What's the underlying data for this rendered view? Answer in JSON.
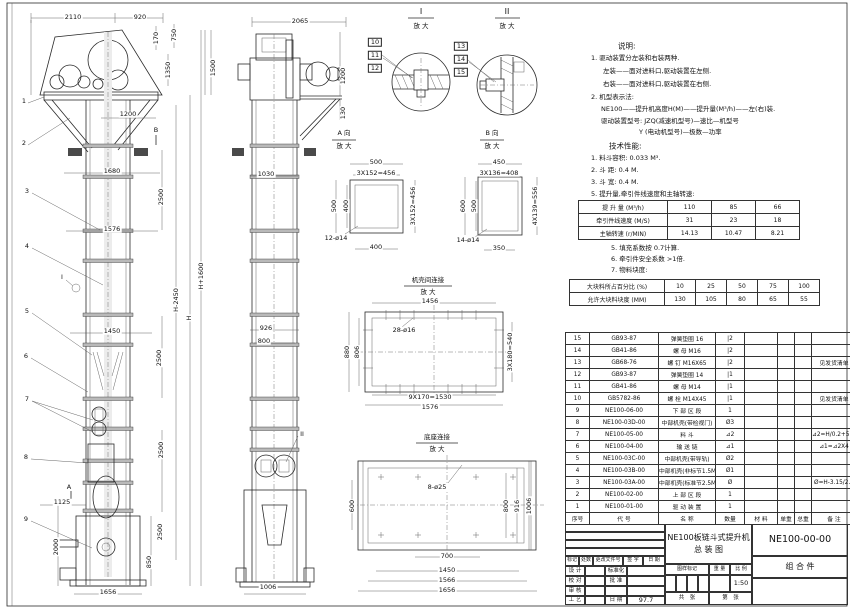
{
  "doc": {
    "drawing_title_line1": "NE100板链斗式提升机",
    "drawing_title_line2": "总  装  图",
    "drawing_no": "NE100-00-00",
    "part_class": "组 合 件",
    "scale": "1:50",
    "date": "97.7"
  },
  "notes_lines": [
    {
      "t": "说明:",
      "x": 617,
      "y": 46,
      "fs": 7.5
    },
    {
      "t": "1. 驱动装置分左装和右装两种.",
      "x": 590,
      "y": 58
    },
    {
      "t": "左装——面对进料口,驱动装置在左侧.",
      "x": 602,
      "y": 71
    },
    {
      "t": "右装——面对进料口,驱动装置在右侧.",
      "x": 602,
      "y": 84
    },
    {
      "t": "2. 机型表示法:",
      "x": 590,
      "y": 97
    },
    {
      "t": "NE100——提升机高度H(M)——提升量(M³/h)——左(右)装.",
      "x": 600,
      "y": 109
    },
    {
      "t": "驱动装置型号: JZQ(减速机型号)—速比—机型号",
      "x": 600,
      "y": 121
    },
    {
      "t": "Y (电动机型号)—极数—功率",
      "x": 638,
      "y": 132
    },
    {
      "t": "技术性能:",
      "x": 608,
      "y": 146,
      "fs": 7.5
    },
    {
      "t": "1. 料斗容积: 0.033 M³.",
      "x": 590,
      "y": 158
    },
    {
      "t": "2. 斗  距: 0.4 M.",
      "x": 590,
      "y": 170
    },
    {
      "t": "3. 斗  宽: 0.4 M.",
      "x": 590,
      "y": 182
    },
    {
      "t": "5. 提升量,牵引件线速度和主轴转速:",
      "x": 590,
      "y": 194
    },
    {
      "t": "5. 填充系数按 0.7计算.",
      "x": 610,
      "y": 248
    },
    {
      "t": "6. 牵引件安全系数 >1倍.",
      "x": 610,
      "y": 259
    },
    {
      "t": "7. 物料块度:",
      "x": 610,
      "y": 270
    }
  ],
  "tech_table1": {
    "rows": [
      {
        "label": "提 升 量 (M³/h)",
        "values": [
          "110",
          "85",
          "66"
        ]
      },
      {
        "label": "牵引件线速度 (M/S)",
        "values": [
          "31",
          "23",
          "18"
        ]
      },
      {
        "label": "主轴转速 (r/MIN)",
        "values": [
          "14.13",
          "10.47",
          "8.21"
        ]
      }
    ]
  },
  "tech_table2": {
    "rows": [
      {
        "label": "大块料所占百分比 (%)",
        "values": [
          "10",
          "25",
          "50",
          "75",
          "100"
        ]
      },
      {
        "label": "允许大块料块度 (MM)",
        "values": [
          "130",
          "105",
          "80",
          "65",
          "55"
        ]
      }
    ]
  },
  "bom": {
    "headers": [
      "序号",
      "代  号",
      "名  称",
      "数量",
      "材  料",
      "单重",
      "总重",
      "备 注"
    ],
    "rows": [
      [
        "15",
        "GB93-87",
        "弹簧垫圈 16",
        "|2",
        "",
        "",
        "",
        ""
      ],
      [
        "14",
        "GB41-86",
        "螺 母 M16",
        "|2",
        "",
        "",
        "",
        ""
      ],
      [
        "13",
        "GB68-76",
        "螺 钉 M16X65",
        "|2",
        "",
        "",
        "",
        "见发货清单"
      ],
      [
        "12",
        "GB93-87",
        "弹簧垫圈 14",
        "|1",
        "",
        "",
        "",
        ""
      ],
      [
        "11",
        "GB41-86",
        "螺 母 M14",
        "|1",
        "",
        "",
        "",
        ""
      ],
      [
        "10",
        "GB5782-86",
        "螺 栓 M14X45",
        "|1",
        "",
        "",
        "",
        "见发货清单"
      ],
      [
        "9",
        "NE100-06-00",
        "下 部 区 段",
        "1",
        "",
        "",
        "",
        ""
      ],
      [
        "8",
        "NE100-03D-00",
        "中部机壳(带检视门)",
        "Ø3",
        "",
        "",
        "",
        ""
      ],
      [
        "7",
        "NE100-05-00",
        "料  斗",
        "⊿2",
        "",
        "",
        "",
        "⊿2=H/0.2+5.75"
      ],
      [
        "6",
        "NE100-04-00",
        "输 送 链",
        "⊿1",
        "",
        "",
        "",
        "⊿1=⊿2X4"
      ],
      [
        "5",
        "NE100-03C-00",
        "中部机壳(带导轨)",
        "Ø2",
        "",
        "",
        "",
        ""
      ],
      [
        "4",
        "NE100-03B-00",
        "中部机壳(非标节1.5M,1M)",
        "Ø1",
        "",
        "",
        "",
        ""
      ],
      [
        "3",
        "NE100-03A-00",
        "中部机壳(标准节2.5M)",
        "Ø",
        "",
        "",
        "",
        "Ø=H-3.15/2.5"
      ],
      [
        "2",
        "NE100-02-00",
        "上 部 区 段",
        "1",
        "",
        "",
        "",
        ""
      ],
      [
        "1",
        "NE100-01-00",
        "驱 动 装 置",
        "1",
        "",
        "",
        "",
        ""
      ]
    ]
  },
  "title_block_cells": [
    {
      "x": 565,
      "y": 524,
      "w": 100,
      "h": 8,
      "t": ""
    },
    {
      "x": 565,
      "y": 532,
      "w": 100,
      "h": 8,
      "t": ""
    },
    {
      "x": 565,
      "y": 540,
      "w": 100,
      "h": 8,
      "t": ""
    },
    {
      "x": 565,
      "y": 548,
      "w": 100,
      "h": 8,
      "t": ""
    },
    {
      "x": 565,
      "y": 556,
      "w": 14,
      "h": 10,
      "t": "标记",
      "fs": 5
    },
    {
      "x": 579,
      "y": 556,
      "w": 14,
      "h": 10,
      "t": "处数",
      "fs": 5
    },
    {
      "x": 593,
      "y": 556,
      "w": 30,
      "h": 10,
      "t": "更改文件号",
      "fs": 5
    },
    {
      "x": 623,
      "y": 556,
      "w": 20,
      "h": 10,
      "t": "签 字",
      "fs": 5
    },
    {
      "x": 643,
      "y": 556,
      "w": 22,
      "h": 10,
      "t": "日 期",
      "fs": 5
    },
    {
      "x": 565,
      "y": 566,
      "w": 20,
      "h": 10,
      "t": "设 计",
      "fs": 5.5
    },
    {
      "x": 585,
      "y": 566,
      "w": 20,
      "h": 10,
      "t": ""
    },
    {
      "x": 605,
      "y": 566,
      "w": 22,
      "h": 10,
      "t": "标准化",
      "fs": 5.5
    },
    {
      "x": 627,
      "y": 566,
      "w": 38,
      "h": 10,
      "t": ""
    },
    {
      "x": 565,
      "y": 576,
      "w": 20,
      "h": 10,
      "t": "校 对",
      "fs": 5.5
    },
    {
      "x": 585,
      "y": 576,
      "w": 20,
      "h": 10,
      "t": ""
    },
    {
      "x": 605,
      "y": 576,
      "w": 22,
      "h": 10,
      "t": "批 准",
      "fs": 5.5
    },
    {
      "x": 627,
      "y": 576,
      "w": 38,
      "h": 10,
      "t": ""
    },
    {
      "x": 565,
      "y": 586,
      "w": 20,
      "h": 10,
      "t": "审 核",
      "fs": 5.5
    },
    {
      "x": 585,
      "y": 586,
      "w": 20,
      "h": 10,
      "t": ""
    },
    {
      "x": 605,
      "y": 586,
      "w": 22,
      "h": 10,
      "t": ""
    },
    {
      "x": 627,
      "y": 586,
      "w": 38,
      "h": 10,
      "t": ""
    },
    {
      "x": 565,
      "y": 596,
      "w": 20,
      "h": 9,
      "t": "工 艺",
      "fs": 5.5
    },
    {
      "x": 585,
      "y": 596,
      "w": 20,
      "h": 9,
      "t": ""
    },
    {
      "x": 605,
      "y": 596,
      "w": 22,
      "h": 9,
      "t": "日 期",
      "fs": 5.5
    },
    {
      "x": 627,
      "y": 596,
      "w": 38,
      "h": 9,
      "t": "97.7",
      "fs": 6.5
    },
    {
      "x": 665,
      "y": 524,
      "w": 87,
      "h": 40,
      "t": "NE100板链斗式提升机\n总  装  图",
      "fs": 8
    },
    {
      "x": 665,
      "y": 564,
      "w": 44,
      "h": 11,
      "t": "图样标记",
      "fs": 5
    },
    {
      "x": 709,
      "y": 564,
      "w": 21,
      "h": 11,
      "t": "重 量",
      "fs": 5
    },
    {
      "x": 730,
      "y": 564,
      "w": 22,
      "h": 11,
      "t": "比 例",
      "fs": 5
    },
    {
      "x": 665,
      "y": 575,
      "w": 11,
      "h": 17,
      "t": ""
    },
    {
      "x": 676,
      "y": 575,
      "w": 11,
      "h": 17,
      "t": ""
    },
    {
      "x": 687,
      "y": 575,
      "w": 11,
      "h": 17,
      "t": ""
    },
    {
      "x": 698,
      "y": 575,
      "w": 11,
      "h": 17,
      "t": ""
    },
    {
      "x": 709,
      "y": 575,
      "w": 21,
      "h": 17,
      "t": ""
    },
    {
      "x": 730,
      "y": 575,
      "w": 22,
      "h": 17,
      "t": "1:50",
      "fs": 6.5
    },
    {
      "x": 665,
      "y": 592,
      "w": 44,
      "h": 13,
      "t": "共　张",
      "fs": 5.5
    },
    {
      "x": 709,
      "y": 592,
      "w": 43,
      "h": 13,
      "t": "第　张",
      "fs": 5.5
    },
    {
      "x": 752,
      "y": 524,
      "w": 96,
      "h": 32,
      "t": "NE100-00-00",
      "fs": 9.5
    },
    {
      "x": 752,
      "y": 556,
      "w": 96,
      "h": 22,
      "t": "组 合 件",
      "fs": 8
    },
    {
      "x": 752,
      "y": 578,
      "w": 96,
      "h": 27,
      "t": ""
    }
  ],
  "labels": {
    "main_view": [
      {
        "t": "2110",
        "x": 73,
        "y": 17
      },
      {
        "t": "920",
        "x": 140,
        "y": 17
      },
      {
        "t": "170",
        "x": 156,
        "y": 38,
        "r": 1
      },
      {
        "t": "750",
        "x": 174,
        "y": 35,
        "r": 1
      },
      {
        "t": "1350",
        "x": 168,
        "y": 70,
        "r": 1
      },
      {
        "t": "1500",
        "x": 213,
        "y": 68,
        "r": 1
      },
      {
        "t": "1200",
        "x": 128,
        "y": 114
      },
      {
        "t": "1680",
        "x": 112,
        "y": 171
      },
      {
        "t": "2500",
        "x": 161,
        "y": 197,
        "r": 1
      },
      {
        "t": "1576",
        "x": 112,
        "y": 229
      },
      {
        "t": "H-2450",
        "x": 176,
        "y": 300,
        "r": 1
      },
      {
        "t": "H",
        "x": 189,
        "y": 318,
        "r": 1
      },
      {
        "t": "H+1600",
        "x": 201,
        "y": 276,
        "r": 1
      },
      {
        "t": "1450",
        "x": 112,
        "y": 331
      },
      {
        "t": "2500",
        "x": 159,
        "y": 358,
        "r": 1
      },
      {
        "t": "2500",
        "x": 161,
        "y": 450,
        "r": 1
      },
      {
        "t": "1125",
        "x": 62,
        "y": 502
      },
      {
        "t": "2000",
        "x": 56,
        "y": 547,
        "r": 1
      },
      {
        "t": "2500",
        "x": 160,
        "y": 532,
        "r": 1
      },
      {
        "t": "850",
        "x": 149,
        "y": 562,
        "r": 1
      },
      {
        "t": "1656",
        "x": 108,
        "y": 592
      },
      {
        "t": "B",
        "x": 156,
        "y": 130
      },
      {
        "t": "I",
        "x": 62,
        "y": 277
      },
      {
        "t": "A",
        "x": 69,
        "y": 487
      }
    ],
    "side_view": [
      {
        "t": "2065",
        "x": 300,
        "y": 21
      },
      {
        "t": "1200",
        "x": 343,
        "y": 76,
        "r": 1
      },
      {
        "t": "130",
        "x": 343,
        "y": 113,
        "r": 1
      },
      {
        "t": "1030",
        "x": 266,
        "y": 174
      },
      {
        "t": "926",
        "x": 266,
        "y": 328
      },
      {
        "t": "800",
        "x": 264,
        "y": 341
      },
      {
        "t": "1006",
        "x": 268,
        "y": 587
      },
      {
        "t": "II",
        "x": 302,
        "y": 434
      }
    ],
    "callouts": [
      {
        "t": "1",
        "x": 24,
        "y": 101
      },
      {
        "t": "2",
        "x": 24,
        "y": 143
      },
      {
        "t": "3",
        "x": 27,
        "y": 191
      },
      {
        "t": "4",
        "x": 27,
        "y": 246
      },
      {
        "t": "5",
        "x": 27,
        "y": 311
      },
      {
        "t": "6",
        "x": 26,
        "y": 356
      },
      {
        "t": "7",
        "x": 27,
        "y": 399
      },
      {
        "t": "8",
        "x": 26,
        "y": 457
      },
      {
        "t": "9",
        "x": 26,
        "y": 519
      },
      {
        "t": "10",
        "x": 375,
        "y": 42,
        "b": 1
      },
      {
        "t": "11",
        "x": 375,
        "y": 55,
        "b": 1
      },
      {
        "t": "12",
        "x": 375,
        "y": 68,
        "b": 1
      },
      {
        "t": "13",
        "x": 461,
        "y": 46,
        "b": 1
      },
      {
        "t": "14",
        "x": 461,
        "y": 59,
        "b": 1
      },
      {
        "t": "15",
        "x": 461,
        "y": 72,
        "b": 1
      }
    ],
    "details": [
      {
        "t": "I",
        "x": 421,
        "y": 12,
        "fs": 8
      },
      {
        "t": "放 大",
        "x": 421,
        "y": 26
      },
      {
        "t": "II",
        "x": 507,
        "y": 12,
        "fs": 8
      },
      {
        "t": "放 大",
        "x": 507,
        "y": 26
      },
      {
        "t": "A 向",
        "x": 344,
        "y": 133
      },
      {
        "t": "放 大",
        "x": 344,
        "y": 146
      },
      {
        "t": "B 向",
        "x": 492,
        "y": 133
      },
      {
        "t": "放 大",
        "x": 492,
        "y": 146
      },
      {
        "t": "500",
        "x": 376,
        "y": 162
      },
      {
        "t": "3X152=456",
        "x": 376,
        "y": 173
      },
      {
        "t": "500",
        "x": 334,
        "y": 206,
        "r": 1
      },
      {
        "t": "400",
        "x": 346,
        "y": 206,
        "r": 1
      },
      {
        "t": "3X152=456",
        "x": 413,
        "y": 206,
        "r": 1
      },
      {
        "t": "12-ø14",
        "x": 336,
        "y": 238
      },
      {
        "t": "400",
        "x": 376,
        "y": 247
      },
      {
        "t": "450",
        "x": 499,
        "y": 162
      },
      {
        "t": "3X136=408",
        "x": 499,
        "y": 173
      },
      {
        "t": "600",
        "x": 463,
        "y": 206,
        "r": 1
      },
      {
        "t": "500",
        "x": 474,
        "y": 206,
        "r": 1
      },
      {
        "t": "4X139=556",
        "x": 535,
        "y": 206,
        "r": 1
      },
      {
        "t": "14-ø14",
        "x": 468,
        "y": 240
      },
      {
        "t": "350",
        "x": 499,
        "y": 248
      },
      {
        "t": "机壳间连接",
        "x": 428,
        "y": 280
      },
      {
        "t": "放 大",
        "x": 428,
        "y": 292
      },
      {
        "t": "1456",
        "x": 430,
        "y": 301
      },
      {
        "t": "28-ø16",
        "x": 404,
        "y": 330
      },
      {
        "t": "880",
        "x": 347,
        "y": 352,
        "r": 1
      },
      {
        "t": "806",
        "x": 357,
        "y": 352,
        "r": 1
      },
      {
        "t": "3X180=540",
        "x": 510,
        "y": 352,
        "r": 1
      },
      {
        "t": "9X170=1530",
        "x": 430,
        "y": 397
      },
      {
        "t": "1576",
        "x": 430,
        "y": 407
      },
      {
        "t": "底座连接",
        "x": 437,
        "y": 437
      },
      {
        "t": "放 大",
        "x": 437,
        "y": 449
      },
      {
        "t": "8-ø25",
        "x": 437,
        "y": 487
      },
      {
        "t": "600",
        "x": 352,
        "y": 506,
        "r": 1
      },
      {
        "t": "800",
        "x": 506,
        "y": 506,
        "r": 1
      },
      {
        "t": "916",
        "x": 517,
        "y": 506,
        "r": 1
      },
      {
        "t": "1006",
        "x": 529,
        "y": 506,
        "r": 1
      },
      {
        "t": "700",
        "x": 447,
        "y": 556
      },
      {
        "t": "1450",
        "x": 447,
        "y": 570
      },
      {
        "t": "1566",
        "x": 447,
        "y": 580
      },
      {
        "t": "1656",
        "x": 447,
        "y": 590
      }
    ]
  }
}
